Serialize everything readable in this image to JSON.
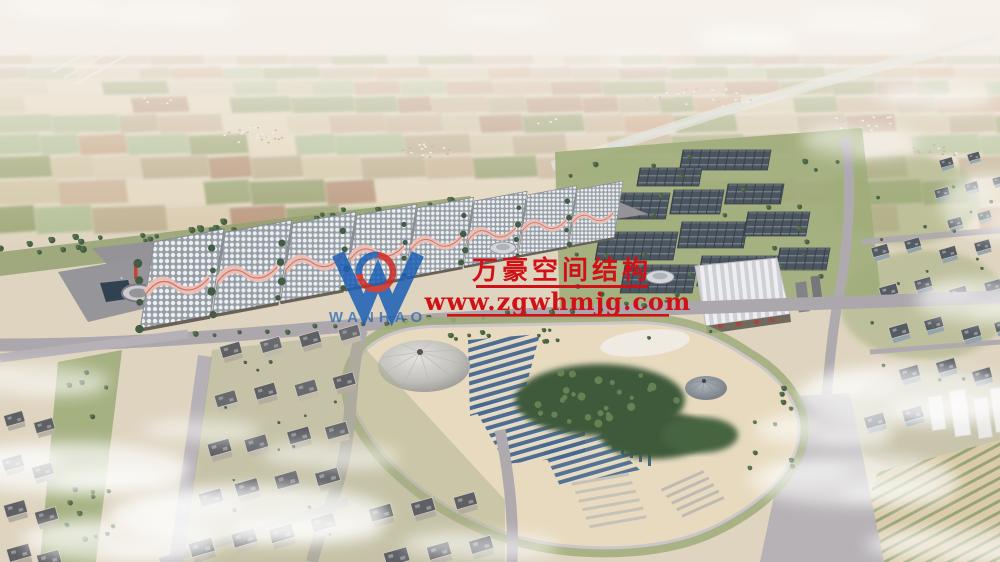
{
  "meta": {
    "type": "aerial architectural rendering",
    "subject": "exhibition and convention complex with vaulted halls, solar farm blocks, central landscaped park, residential district and hazy farmland horizon"
  },
  "watermark": {
    "company_logo_text": "WANHAO",
    "company_name": "万豪空间结构",
    "website": "www.zgwhmjg.com",
    "text_color": "#d01116",
    "logo_blue": "#1b5fb6",
    "logo_red": "#cc2a28"
  },
  "palette": {
    "haze": "#f4efe9",
    "field_tan": "#cfc2a0",
    "field_green": "#94a069",
    "tree_green": "#3b5439",
    "road_gray": "#a7a2a9",
    "plaza_gray": "#8e8c93",
    "hall_roof_white": "#eceef1",
    "hall_crest_pink": "#ecbcb2",
    "solar_slate": "#3f4a55",
    "park_ground": "#e7d9bd",
    "park_panel_blue": "#3b5e88",
    "water_dark": "#223547",
    "residential_face": "#b0a99b",
    "city_face": "#8fa0aa"
  }
}
